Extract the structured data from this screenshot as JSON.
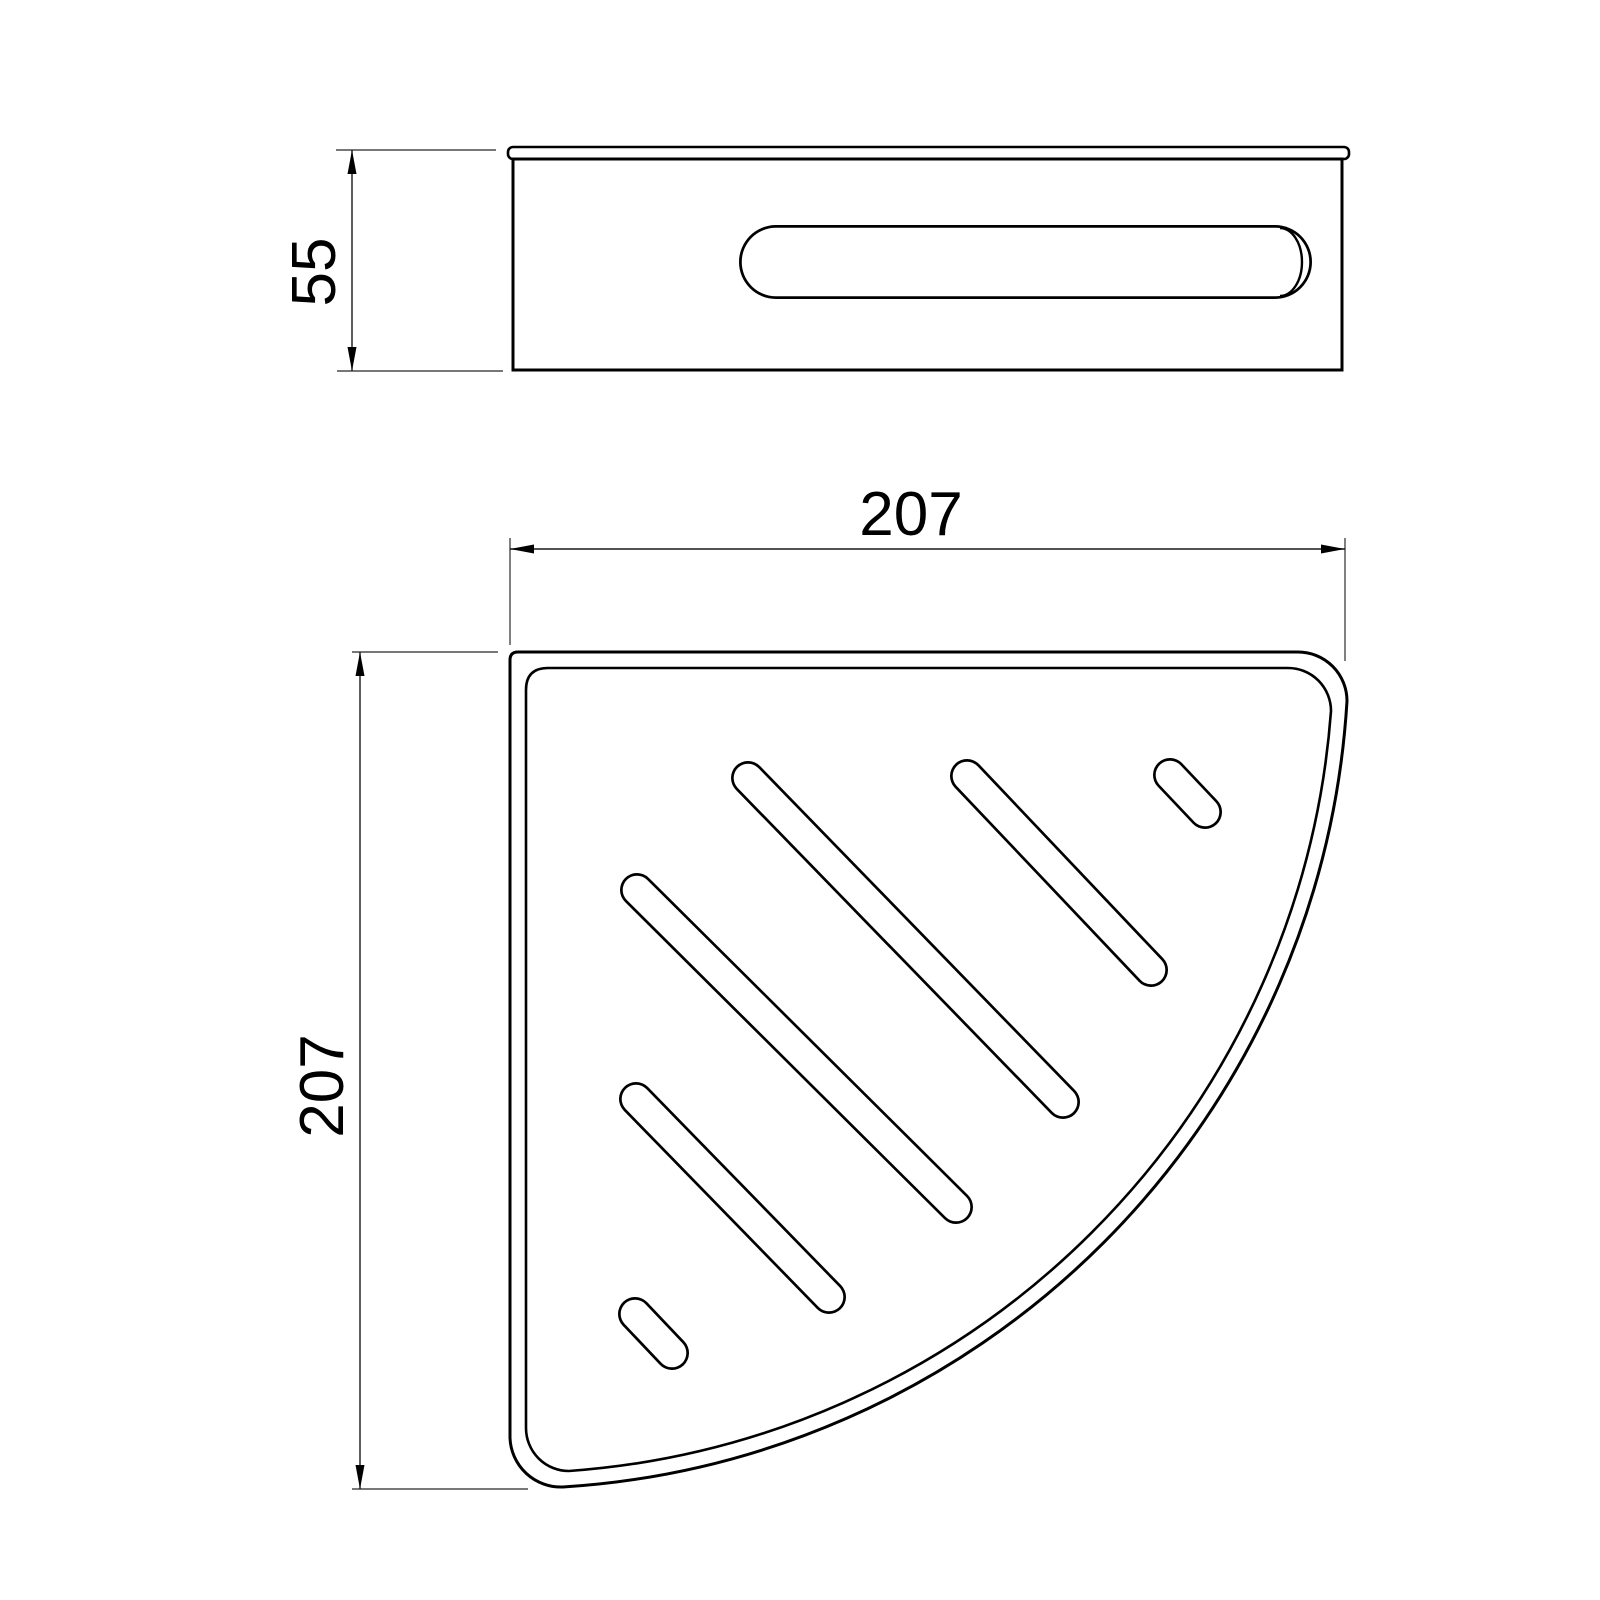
{
  "drawing": {
    "background": "#ffffff",
    "object_line_color": "#000000",
    "dim_line_color": "#1a1a1a",
    "ext_line_color": "#4a4a4a",
    "object_stroke_width": 3,
    "inner_stroke_width": 2.6,
    "dim_stroke_width": 1.4,
    "slot_outer_width": 34,
    "slot_inner_width": 28.6,
    "side_slot_outer_width": 74,
    "side_slot_inner_width": 68.5,
    "plan_slots": [
      {
        "x1": 748,
        "y1": 778,
        "x2": 1063,
        "y2": 1102
      },
      {
        "x1": 967,
        "y1": 776,
        "x2": 1151,
        "y2": 970
      },
      {
        "x1": 1170,
        "y1": 775,
        "x2": 1205,
        "y2": 812
      },
      {
        "x1": 637,
        "y1": 890,
        "x2": 956,
        "y2": 1207
      },
      {
        "x1": 636,
        "y1": 1099,
        "x2": 829,
        "y2": 1297
      },
      {
        "x1": 635,
        "y1": 1314,
        "x2": 672,
        "y2": 1353
      }
    ]
  },
  "dimensions": {
    "side_height": {
      "label": "55"
    },
    "plan_width": {
      "label": "207"
    },
    "plan_depth": {
      "label": "207"
    }
  }
}
